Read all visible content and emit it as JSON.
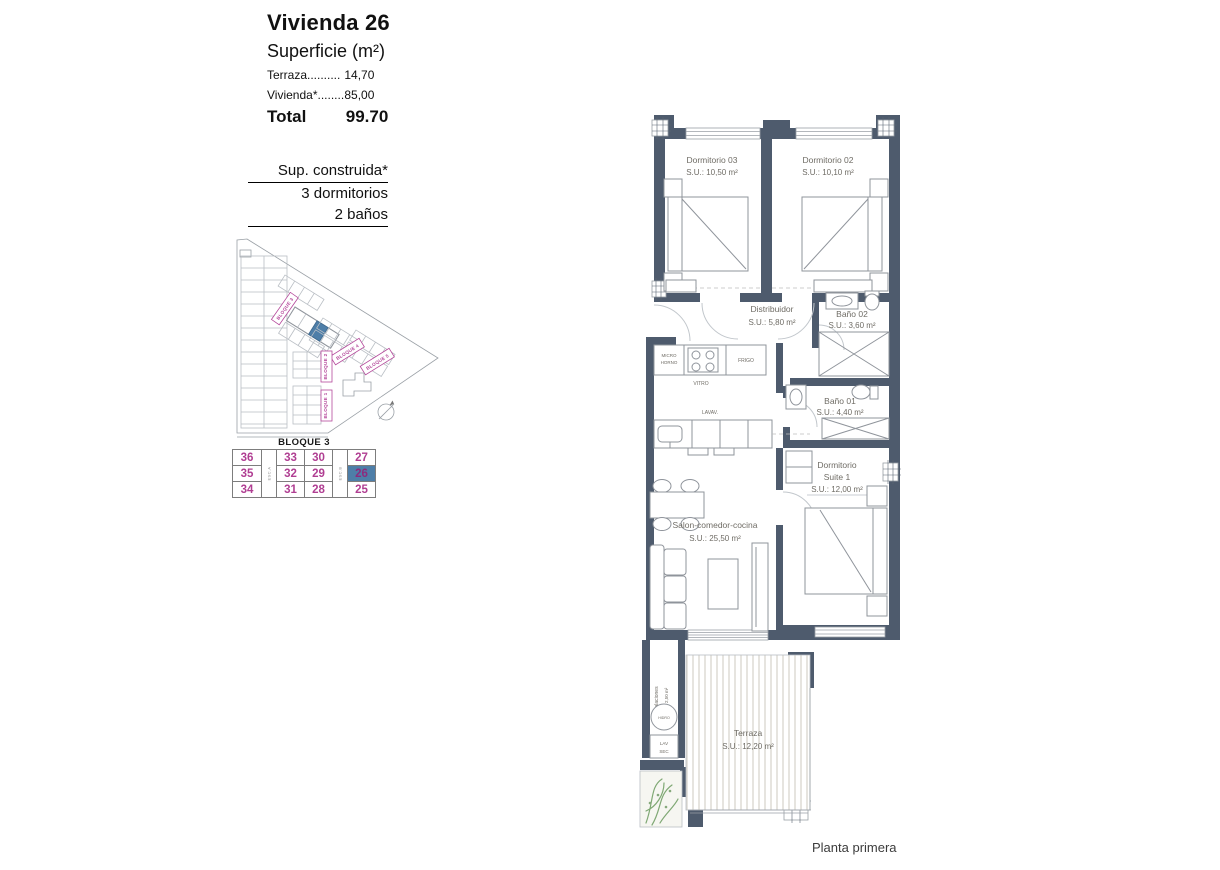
{
  "colors": {
    "wall": "#4e5b6d",
    "accent_pink": "#b5489b",
    "number_pink": "#b03e92",
    "highlight_blue": "#4e7ea8",
    "furniture_line": "#8f949b",
    "label_text": "#6f6c65",
    "deck_line": "#d6d3ca",
    "plant_green": "#7fa874"
  },
  "header": {
    "title": "Vivienda 26",
    "subtitle": "Superficie (m²)",
    "terraza_label": "Terraza..........",
    "terraza_value": "14,70",
    "vivienda_label": "Vivienda*........",
    "vivienda_value": "85,00",
    "total_label": "Total",
    "total_value": "99.70"
  },
  "construida": {
    "line1": "Sup. construida*",
    "line2": "3 dormitorios",
    "line3": "2 baños"
  },
  "siteplan": {
    "b1": "BLOQUE 1",
    "b2": "BLOQUE 2",
    "b3": "BLOQUE 3",
    "b4": "BLOQUE 4",
    "b5": "BLOQUE 5"
  },
  "block_table": {
    "title": "BLOQUE 3",
    "esc_a": "ESC.A",
    "esc_b": "ESC.B",
    "highlight": "26",
    "rows": [
      [
        "36",
        "33",
        "30",
        "27"
      ],
      [
        "35",
        "32",
        "29",
        "26"
      ],
      [
        "34",
        "31",
        "28",
        "25"
      ]
    ]
  },
  "plan": {
    "dorm03": {
      "name": "Dormitorio 03",
      "area": "S.U.: 10,50 m²"
    },
    "dorm02": {
      "name": "Dormitorio 02",
      "area": "S.U.: 10,10 m²"
    },
    "distribuidor": {
      "name": "Distribuidor",
      "area": "S.U.: 5,80 m²"
    },
    "bano02": {
      "name": "Baño 02",
      "area": "S.U.: 3,60 m²"
    },
    "bano01": {
      "name": "Baño 01",
      "area": "S.U.: 4,40 m²"
    },
    "suite": {
      "name1": "Dormitorio",
      "name2": "Suite 1",
      "area": "S.U.: 12,00 m²"
    },
    "salon": {
      "name": "Salon-comedor-cocina",
      "area": "S.U.: 25,50 m²"
    },
    "terraza": {
      "name": "Terraza",
      "area": "S.U.: 12,20 m²"
    },
    "instalaciones": {
      "name": "Instalaciones",
      "area": "S.U.: 2,50 m²"
    },
    "labels": {
      "micro1": "MICRO",
      "micro2": "HORNO",
      "vitro": "VITRO",
      "frigo": "FRIGO",
      "lavav": "LAVAV.",
      "hidro": "HIDRO",
      "lav": "LAV",
      "sec": "SEC"
    }
  },
  "footer": {
    "caption": "Planta primera"
  }
}
